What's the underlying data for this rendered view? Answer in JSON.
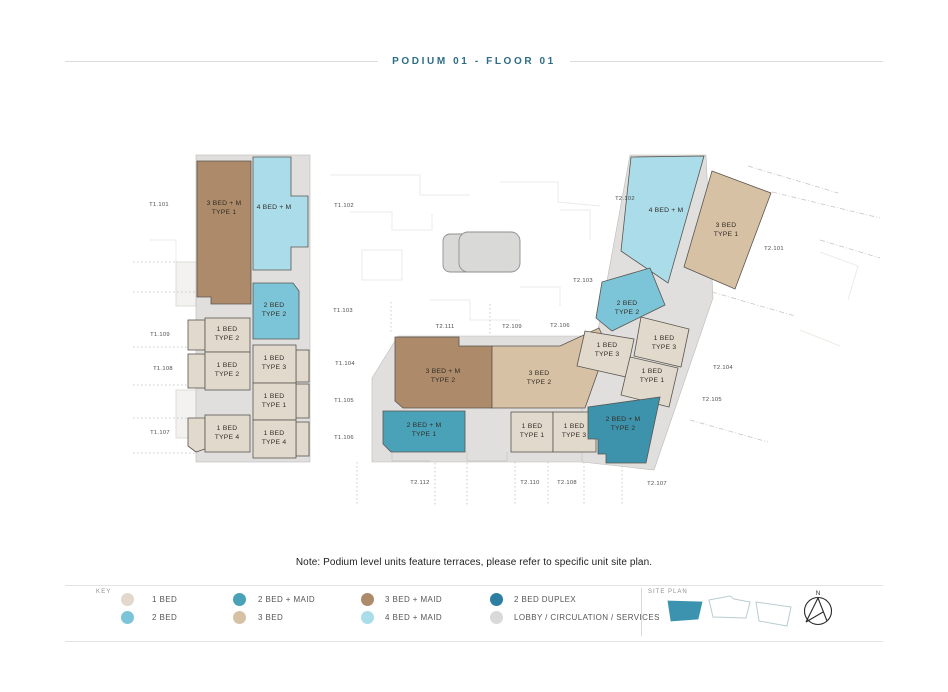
{
  "title": "PODIUM 01 - FLOOR 01",
  "note": "Note: Podium level units feature terraces, please refer to specific unit site plan.",
  "palette": {
    "accent": "#2e6d86",
    "bed1": "#e0d9cc",
    "bed2": "#7cc5d8",
    "bed2_maid": "#4aa2b9",
    "bed2_maid_dark": "#3c93ab",
    "bed3": "#d7c1a4",
    "bed3_maid": "#ac8a6a",
    "bed4_maid": "#abdcea",
    "bed2_duplex": "#2c7fa0",
    "lobby": "#d9d9d7",
    "corridor": "#e0dfdd",
    "siteplan_fill": "#3b93af"
  },
  "plan": {
    "units": [
      {
        "line1": "3 BED + M",
        "line2": "TYPE 1"
      },
      {
        "line1": "4 BED + M"
      },
      {
        "line1": "2 BED",
        "line2": "TYPE 2"
      },
      {
        "line1": "1 BED",
        "line2": "TYPE 2"
      },
      {
        "line1": "1 BED",
        "line2": "TYPE 2"
      },
      {
        "line1": "1 BED",
        "line2": "TYPE 3"
      },
      {
        "line1": "1 BED",
        "line2": "TYPE 1"
      },
      {
        "line1": "1 BED",
        "line2": "TYPE 4"
      },
      {
        "line1": "1 BED",
        "line2": "TYPE 4"
      },
      {
        "line1": "3 BED + M",
        "line2": "TYPE 2"
      },
      {
        "line1": "3 BED",
        "line2": "TYPE 2"
      },
      {
        "line1": "2 BED + M",
        "line2": "TYPE 1"
      },
      {
        "line1": "1 BED",
        "line2": "TYPE 1"
      },
      {
        "line1": "1 BED",
        "line2": "TYPE 3"
      },
      {
        "line1": "4 BED + M"
      },
      {
        "line1": "3 BED",
        "line2": "TYPE 1"
      },
      {
        "line1": "2 BED",
        "line2": "TYPE 2"
      },
      {
        "line1": "1 BED",
        "line2": "TYPE 3"
      },
      {
        "line1": "1 BED",
        "line2": "TYPE 3"
      },
      {
        "line1": "1 BED",
        "line2": "TYPE 1"
      },
      {
        "line1": "2 BED + M",
        "line2": "TYPE 2"
      }
    ],
    "refs": [
      "T1.101",
      "T1.102",
      "T1.103",
      "T1.104",
      "T1.105",
      "T1.106",
      "T1.107",
      "T1.108",
      "T1.109",
      "T2.101",
      "T2.102",
      "T2.103",
      "T2.104",
      "T2.105",
      "T2.106",
      "T2.107",
      "T2.108",
      "T2.109",
      "T2.110",
      "T2.111",
      "T2.112"
    ]
  },
  "legend": {
    "key_label": "KEY",
    "items": [
      {
        "label": "1 BED",
        "color": "bed1"
      },
      {
        "label": "2 BED",
        "color": "bed2"
      },
      {
        "label": "2 BED + MAID",
        "color": "bed2_maid"
      },
      {
        "label": "3 BED",
        "color": "bed3"
      },
      {
        "label": "3 BED + MAID",
        "color": "bed3_maid"
      },
      {
        "label": "4 BED + MAID",
        "color": "bed4_maid"
      },
      {
        "label": "2 BED DUPLEX",
        "color": "bed2_duplex"
      },
      {
        "label": "LOBBY / CIRCULATION / SERVICES",
        "color": "lobby"
      }
    ],
    "site_plan_label": "SITE PLAN",
    "north_label": "N"
  }
}
